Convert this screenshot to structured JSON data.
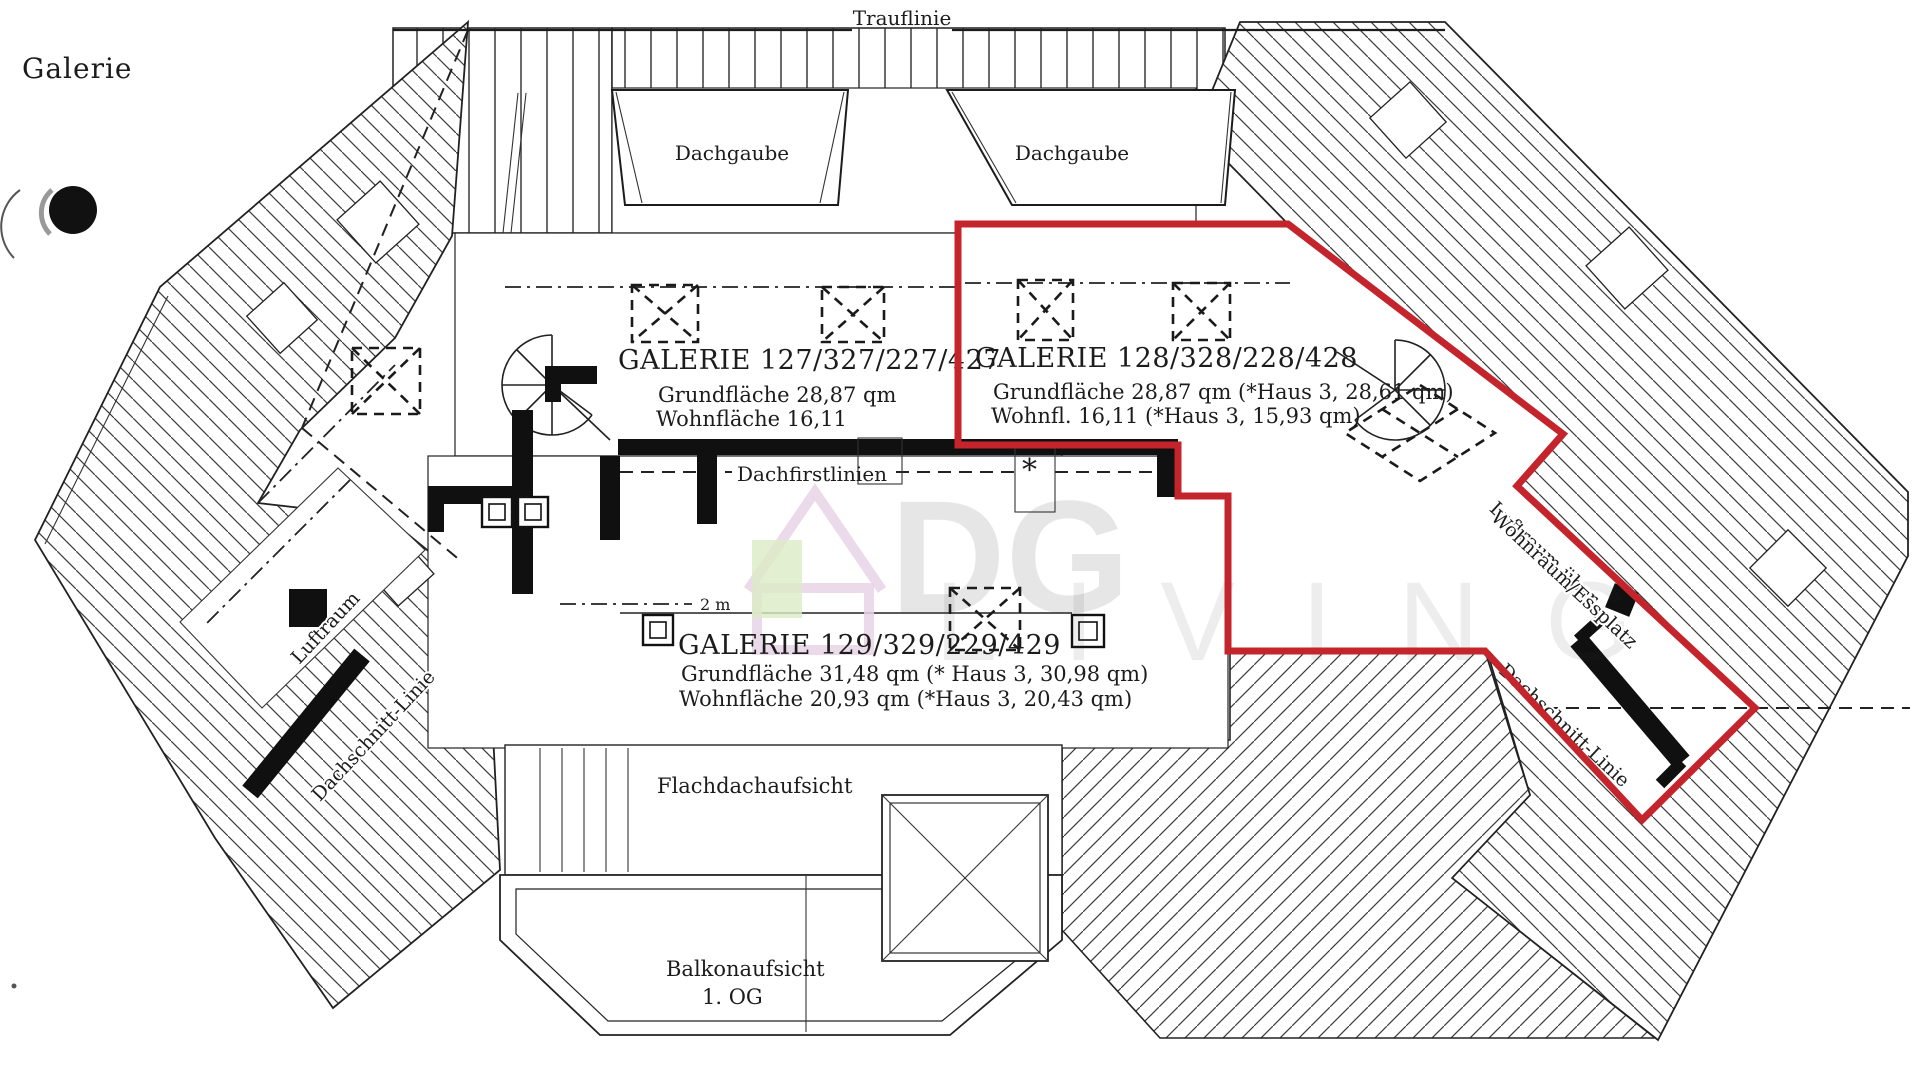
{
  "page": {
    "title": "Galerie",
    "background": "#ffffff"
  },
  "labels": {
    "trauflinie": "Trauflinie",
    "dachgaube": "Dachgaube",
    "dachfirstlinien": "Dachfirstlinien",
    "flachdach": "Flachdachaufsicht",
    "balkon_line1": "Balkonaufsicht",
    "balkon_line2": "1. OG",
    "luftraum": "Luftraum",
    "dachschnitt_left": "Dachschnitt-Linie",
    "dachschnitt_right": "Dachschnitt-Linie",
    "luftraum_right_line1": "Luftraum über",
    "luftraum_right_line2": "Wohnraum/Essplatz",
    "scale": "2 m",
    "asterisk": "*"
  },
  "units": [
    {
      "name": "GALERIE 127/327/227/427",
      "area_line": "Grundfläche 28,87 qm",
      "living_line": "Wohnfläche 16,11"
    },
    {
      "name": "GALERIE 128/328/228/428",
      "area_line": "Grundfläche 28,87 qm (*Haus 3, 28,61 qm)",
      "living_line": "Wohnfl. 16,11 (*Haus 3, 15,93 qm)",
      "highlighted": true
    },
    {
      "name": "GALERIE 129/329/229/429",
      "area_line": "Grundfläche 31,48 qm (* Haus 3, 30,98 qm)",
      "living_line": "Wohnfläche 20,93 qm (*Haus 3, 20,43 qm)"
    }
  ],
  "annotation": {
    "highlight_color": "#c4242b",
    "highlighted_unit": "GALERIE 128/328/228/428"
  },
  "watermark": {
    "line1": "DG",
    "line2": "LIVING"
  }
}
